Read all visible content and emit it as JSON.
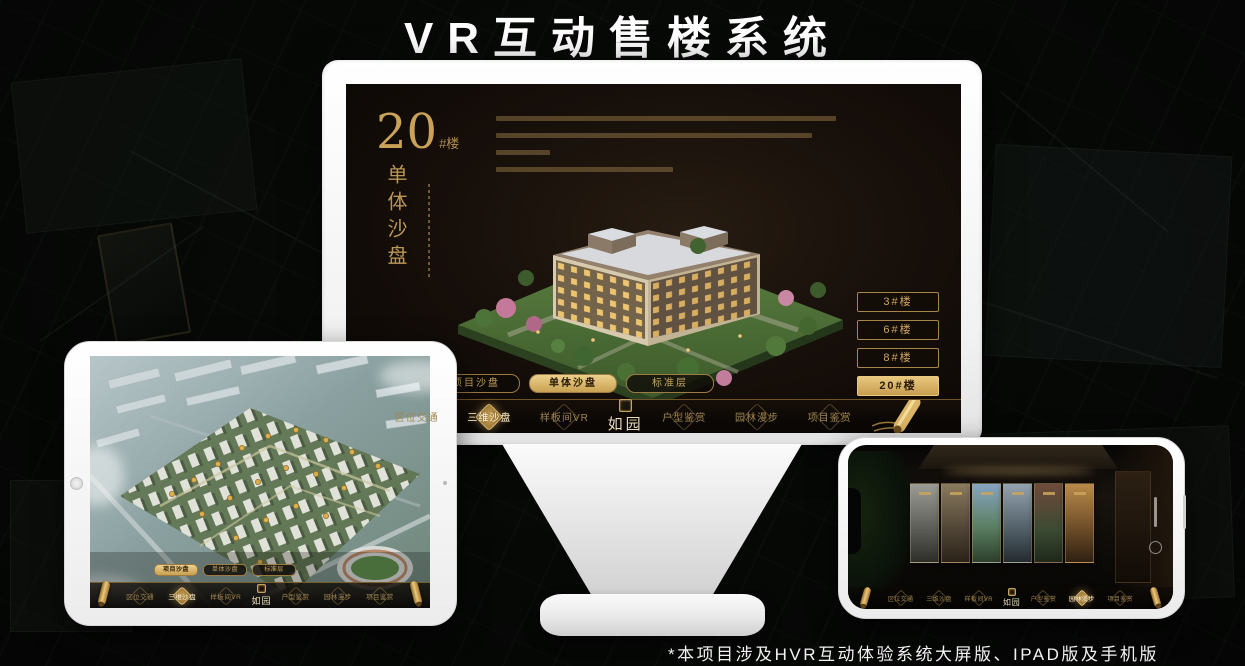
{
  "page": {
    "title": "VR互动售楼系统",
    "footnote": "*本项目涉及HVR互动体验系统大屏版、IPAD版及手机版"
  },
  "colors": {
    "gold": "#c9a45c",
    "gold_bright": "#e6c57e",
    "screen_bg": "#16100b",
    "nav_bg": "#0a0705"
  },
  "app": {
    "logo": "如园",
    "unit_title": {
      "number": "20",
      "suffix": "#楼",
      "subtitle": "单体沙盘"
    },
    "floor_buttons": [
      {
        "label": "3#楼",
        "active": false
      },
      {
        "label": "6#楼",
        "active": false
      },
      {
        "label": "8#楼",
        "active": false
      },
      {
        "label": "20#楼",
        "active": true
      }
    ],
    "sub_tabs": [
      {
        "label": "项目沙盘"
      },
      {
        "label": "单体沙盘"
      },
      {
        "label": "标准层"
      }
    ],
    "nav_items": [
      {
        "label": "区位交通"
      },
      {
        "label": "三维沙盘"
      },
      {
        "label": "样板间VR"
      },
      {
        "label": "户型鉴赏"
      },
      {
        "label": "园林漫步"
      },
      {
        "label": "项目鉴赏"
      }
    ]
  },
  "devices": {
    "monitor": {
      "active_sub_tab": "单体沙盘",
      "active_nav": "三维沙盘",
      "active_floor": "20#楼"
    },
    "ipad": {
      "active_sub_tab": "项目沙盘",
      "active_nav": "三维沙盘"
    },
    "phone": {
      "active_nav": "园林漫步"
    }
  }
}
